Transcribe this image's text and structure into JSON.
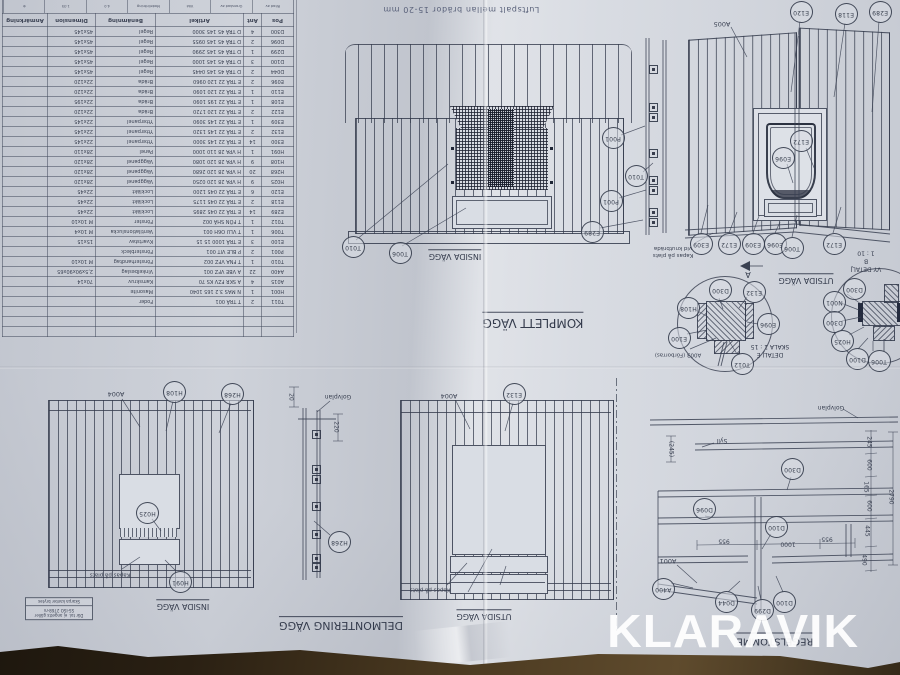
{
  "watermark": "KLARAVIK",
  "top_note": "Luftspalt mellan brädor 15-20 mm",
  "tolerance_note": {
    "line1": "Där tol. ej angetts gäller",
    "line2": "SS-ISO 2768-m",
    "line3": "Skarpa kanter brytes"
  },
  "title_strip": {
    "cells": [
      "Ritad av",
      "Granskad av",
      "Vikt",
      "Modellritning",
      "4.0",
      "1:35",
      "⊕"
    ]
  },
  "parts_table": {
    "headers": [
      "Pos",
      "Ant",
      "Artikel",
      "Benämning",
      "Dimension",
      "Anmärkning"
    ],
    "rows": [
      [
        "T011",
        "2",
        "T TRÄ 001",
        "Foder",
        ""
      ],
      [
        "H001",
        "1",
        "N MAS 3.2 165 1040",
        "Masonite",
        ""
      ],
      [
        "A015",
        "4",
        "A SKR FZV KS 70",
        "Kamskruv",
        "70x14"
      ],
      [
        "A400",
        "22",
        "A VBE VFZ 001",
        "Vinkelbeslag",
        "2,5x90x90x65"
      ],
      [
        "T010",
        "1",
        "T FNA VFZ 002",
        "Fönsterhandtag",
        "M 10x10"
      ],
      [
        "P001",
        "2",
        "P BLE VIT 001",
        "Fönsterbleck",
        ""
      ],
      [
        "E100",
        "3",
        "E TRÄ 1000 15 15",
        "Kvartstav",
        "15x15"
      ],
      [
        "T006",
        "1",
        "T VLU O6H 001",
        "Ventilationslucka",
        "M 10x4"
      ],
      [
        "T012",
        "1",
        "T FÖN SHÄ 002",
        "Fönster",
        "M 10x10"
      ],
      [
        "E289",
        "14",
        "E TRÄ 22 045 2895",
        "Lockläkt",
        "22x45"
      ],
      [
        "E118",
        "2",
        "E TRÄ 22 045 1175",
        "Lockläkt",
        "22x45"
      ],
      [
        "E120",
        "6",
        "E TRÄ 22 045 1200",
        "Lockläkt",
        "22x45"
      ],
      [
        "H025",
        "9",
        "H VPA 28 120 0250",
        "Väggpanel",
        "28x120"
      ],
      [
        "H268",
        "20",
        "H VPA 28 120 2680",
        "Väggpanel",
        "28x120"
      ],
      [
        "H108",
        "9",
        "H VPA 28 120 1080",
        "Väggpanel",
        "28x120"
      ],
      [
        "H091",
        "1",
        "H VPA 28 110 1000",
        "Panel",
        "28x110"
      ],
      [
        "E300",
        "14",
        "E TRÄ 22 145 3000",
        "Ytterpanel",
        "22x145"
      ],
      [
        "E132",
        "2",
        "E TRÄ 22 145 1320",
        "Ytterpanel",
        "22x145"
      ],
      [
        "E309",
        "1",
        "E TRÄ 22 145 3090",
        "Ytterpanel",
        "22x145"
      ],
      [
        "E122",
        "2",
        "E TRÄ 22 120 1720",
        "Bräda",
        "22x120"
      ],
      [
        "E108",
        "1",
        "E TRÄ 22 195 1090",
        "Bräda",
        "22x195"
      ],
      [
        "E110",
        "1",
        "E TRÄ 22 120 1090",
        "Bräda",
        "22x120"
      ],
      [
        "E096",
        "2",
        "E TRÄ 22 120 0960",
        "Bräda",
        "22x120"
      ],
      [
        "D044",
        "2",
        "D TRÄ 45 145 0445",
        "Regel",
        "45x145"
      ],
      [
        "D100",
        "3",
        "D TRÄ 45 145 1000",
        "Regel",
        "45x145"
      ],
      [
        "D299",
        "1",
        "D TRÄ 45 145 2990",
        "Regel",
        "45x145"
      ],
      [
        "D096",
        "2",
        "D TRÄ 45 145 0955",
        "Regel",
        "45x145"
      ],
      [
        "D300",
        "4",
        "D TRÄ 45 145 3000",
        "Regel",
        "45x145"
      ]
    ]
  },
  "captions": [
    {
      "text": "INSIDA VÄGG",
      "x": 455,
      "y": 255,
      "size": 8,
      "u": 1
    },
    {
      "text": "KOMPLETT VÄGG",
      "x": 533,
      "y": 321,
      "size": 12,
      "u": 1
    },
    {
      "text": "UTSIDA VÄGG",
      "x": 806,
      "y": 279,
      "size": 8,
      "u": 1
    },
    {
      "text": "DETALJ E\nSKALA 1 : 15",
      "x": 770,
      "y": 350,
      "size": 6,
      "u": 0
    },
    {
      "text": "VY DETALJ B\n1 : 10",
      "x": 866,
      "y": 261,
      "size": 6,
      "u": 0
    },
    {
      "text": "INSIDA VÄGG",
      "x": 183,
      "y": 605,
      "size": 8,
      "u": 1
    },
    {
      "text": "UTSIDA VÄGG",
      "x": 484,
      "y": 615,
      "size": 8,
      "u": 1
    },
    {
      "text": "DELMONTERING VÄGG",
      "x": 341,
      "y": 624,
      "size": 11,
      "u": 1
    },
    {
      "text": "REGELSTOMME",
      "x": 775,
      "y": 640,
      "size": 10,
      "u": 1
    },
    {
      "text": "A",
      "x": 748,
      "y": 274,
      "size": 8,
      "u": 0
    }
  ],
  "labels": [
    {
      "text": "A005",
      "x": 722,
      "y": 24,
      "size": 6.5
    },
    {
      "text": "A004",
      "x": 116,
      "y": 394,
      "size": 6.5
    },
    {
      "text": "A004",
      "x": 449,
      "y": 396,
      "size": 6.5
    },
    {
      "text": "A001",
      "x": 668,
      "y": 561,
      "size": 6.5
    },
    {
      "text": "A003 (Förborras)",
      "x": 678,
      "y": 354,
      "size": 5.5
    },
    {
      "text": "Syll",
      "x": 722,
      "y": 440,
      "size": 6
    },
    {
      "text": "Golvplan",
      "x": 831,
      "y": 407,
      "size": 6
    },
    {
      "text": "Golvplan",
      "x": 338,
      "y": 396,
      "size": 6
    },
    {
      "text": "Kapas på plats",
      "x": 110,
      "y": 574,
      "size": 5.5
    },
    {
      "text": "Kapas på plats",
      "x": 430,
      "y": 589,
      "size": 5.5
    },
    {
      "text": "Kapas på plats\nvid knutbräda",
      "x": 673,
      "y": 251,
      "size": 5.5
    }
  ],
  "balloons": [
    {
      "label": "T010",
      "x": 352,
      "y": 246
    },
    {
      "label": "T006",
      "x": 399,
      "y": 252
    },
    {
      "label": "P001",
      "x": 612,
      "y": 137
    },
    {
      "label": "T010",
      "x": 635,
      "y": 175
    },
    {
      "label": "P001",
      "x": 610,
      "y": 200
    },
    {
      "label": "E289",
      "x": 591,
      "y": 231
    },
    {
      "label": "E120",
      "x": 800,
      "y": 11
    },
    {
      "label": "E118",
      "x": 845,
      "y": 13
    },
    {
      "label": "E289",
      "x": 879,
      "y": 11
    },
    {
      "label": "E172",
      "x": 800,
      "y": 140
    },
    {
      "label": "E096",
      "x": 782,
      "y": 157
    },
    {
      "label": "E309",
      "x": 700,
      "y": 243
    },
    {
      "label": "E172",
      "x": 728,
      "y": 243
    },
    {
      "label": "E309",
      "x": 752,
      "y": 243
    },
    {
      "label": "E096",
      "x": 774,
      "y": 243
    },
    {
      "label": "T006",
      "x": 791,
      "y": 247
    },
    {
      "label": "E172",
      "x": 833,
      "y": 243
    },
    {
      "label": "D300",
      "x": 719,
      "y": 289
    },
    {
      "label": "E132",
      "x": 753,
      "y": 291
    },
    {
      "label": "H108",
      "x": 687,
      "y": 307
    },
    {
      "label": "E100",
      "x": 678,
      "y": 337
    },
    {
      "label": "E096",
      "x": 767,
      "y": 323
    },
    {
      "label": "T012",
      "x": 741,
      "y": 363
    },
    {
      "label": "D300",
      "x": 853,
      "y": 288
    },
    {
      "label": "N001",
      "x": 833,
      "y": 301
    },
    {
      "label": "D300",
      "x": 833,
      "y": 321
    },
    {
      "label": "H025",
      "x": 841,
      "y": 340
    },
    {
      "label": "D100",
      "x": 856,
      "y": 358
    },
    {
      "label": "T006",
      "x": 878,
      "y": 360
    },
    {
      "label": "D300",
      "x": 791,
      "y": 468
    },
    {
      "label": "D096",
      "x": 703,
      "y": 508
    },
    {
      "label": "D100",
      "x": 775,
      "y": 526
    },
    {
      "label": "A400",
      "x": 662,
      "y": 588
    },
    {
      "label": "D044",
      "x": 725,
      "y": 601
    },
    {
      "label": "D299",
      "x": 761,
      "y": 609
    },
    {
      "label": "D100",
      "x": 783,
      "y": 601
    },
    {
      "label": "H108",
      "x": 173,
      "y": 391
    },
    {
      "label": "H268",
      "x": 231,
      "y": 393
    },
    {
      "label": "H025",
      "x": 146,
      "y": 512
    },
    {
      "label": "H091",
      "x": 179,
      "y": 581
    },
    {
      "label": "H268",
      "x": 338,
      "y": 541
    },
    {
      "label": "E132",
      "x": 513,
      "y": 393
    }
  ],
  "dims": [
    {
      "t": "20",
      "x": 291,
      "y": 397,
      "v": 1
    },
    {
      "t": "220",
      "x": 336,
      "y": 427,
      "v": 1
    },
    {
      "t": "(245)",
      "x": 671,
      "y": 449,
      "v": 1
    },
    {
      "t": "245",
      "x": 869,
      "y": 442,
      "v": 1
    },
    {
      "t": "600",
      "x": 869,
      "y": 465,
      "v": 1
    },
    {
      "t": "165",
      "x": 866,
      "y": 487,
      "v": 1
    },
    {
      "t": "600",
      "x": 869,
      "y": 506,
      "v": 1
    },
    {
      "t": "445",
      "x": 867,
      "y": 531,
      "v": 1
    },
    {
      "t": "490",
      "x": 864,
      "y": 560,
      "v": 1
    },
    {
      "t": "2790",
      "x": 891,
      "y": 497,
      "v": 1
    },
    {
      "t": "955",
      "x": 724,
      "y": 541,
      "v": 0
    },
    {
      "t": "1000",
      "x": 788,
      "y": 544,
      "v": 0
    },
    {
      "t": "955",
      "x": 827,
      "y": 539,
      "v": 0
    }
  ],
  "panel_clips": {
    "strip_top": {
      "x": 648.5,
      "ys": [
        65,
        103,
        113,
        149,
        176,
        186,
        208,
        218
      ]
    },
    "strip_bottom": {
      "x": 311.5,
      "ys": [
        430,
        465,
        475,
        502,
        530,
        554,
        563
      ]
    }
  }
}
